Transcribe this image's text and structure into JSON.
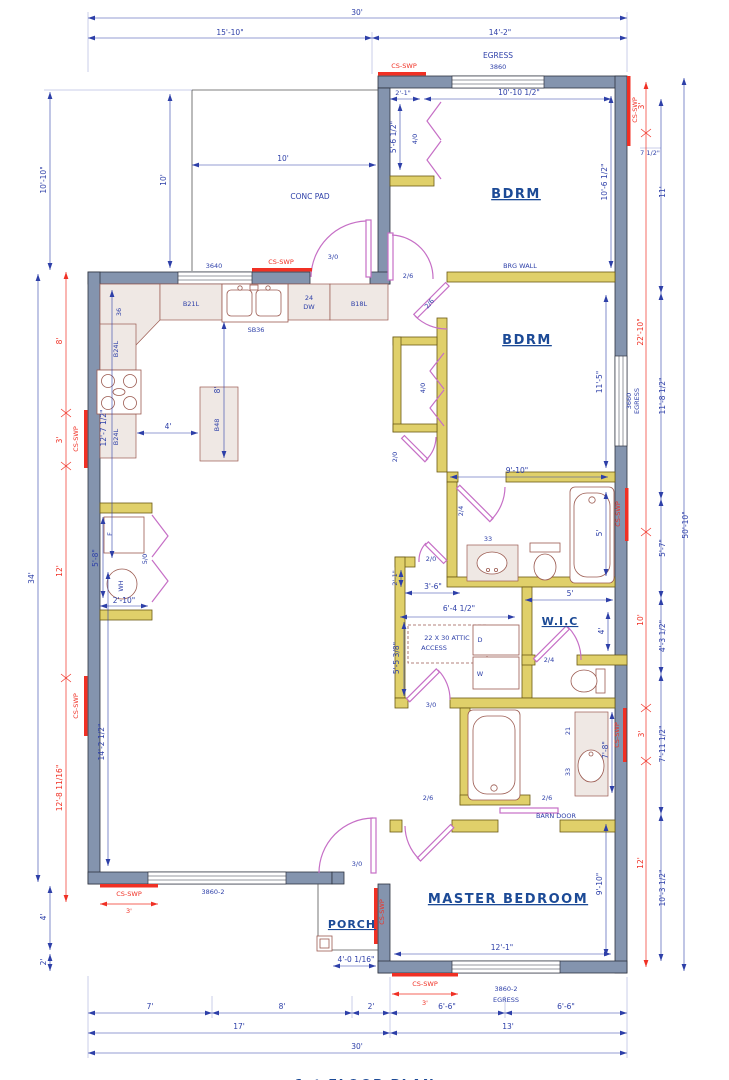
{
  "colors": {
    "wall": "#8494ae",
    "interior_wall": "#e0d06a",
    "door": "#c66fc6",
    "dim": "#2d3fa8",
    "shear": "#f03024",
    "fixture": "#9b5a50",
    "cabinet": "#efe8e4",
    "label": "#1c4a96"
  },
  "title": {
    "text": "1st FLOOR PLAN"
  },
  "shear": {
    "label": "CS-SWP",
    "len3": "3'"
  },
  "dims": {
    "top": {
      "overall": "30'",
      "left": "15'-10\"",
      "right": "14'-2\""
    },
    "bottom": {
      "s7": "7'",
      "s8": "8'",
      "s2": "2'",
      "s6a": "6'-6\"",
      "s6b": "6'-6\"",
      "s17": "17'",
      "s13": "13'",
      "s30": "30'"
    },
    "left": {
      "upper": "10'-10\"",
      "total": "34'",
      "red8": "8'",
      "red12": "12'",
      "red12_8": "12'-8 11/16\"",
      "low4": "4'",
      "low2": "2'",
      "inner12_7": "12'-7 1/2\"",
      "inner14_2": "14'-2 1/2\""
    },
    "right": {
      "red3a": "3'",
      "blue7h": "7 1/2\"",
      "blue11": "11'",
      "red22": "22'-10\"",
      "blue11_8": "11'-8 1/2\"",
      "blue5_7": "5'-7\"",
      "red10": "10'",
      "blue4_3": "4'-3 1/2\"",
      "blue7_11": "7'-11 1/2\"",
      "red12": "12'",
      "blue10_3": "10'-3 1/2\"",
      "total": "50'-10\""
    }
  },
  "areas": {
    "top_window": {
      "egress": "EGRESS",
      "size": "3860"
    },
    "bdrm1": {
      "name": "BDRM",
      "w": "10'-10 1/2\"",
      "h": "10'-6 1/2\"",
      "closet_w": "2'-1\"",
      "closet_h": "5'-6 1/2\"",
      "closet_door": "4/0",
      "brg": "BRG WALL",
      "door": "2/6",
      "door2": "2/6"
    },
    "conc": {
      "name": "CONC PAD",
      "w": "10'",
      "h": "10'",
      "window": "3640",
      "door": "3/0"
    },
    "kitchen": {
      "corner": "36",
      "b21l": "B21L",
      "sink": "SB36",
      "dw_top": "24",
      "dw_bot": "DW",
      "b18l": "B18L",
      "b24la": "B24L",
      "b24lb": "B24L",
      "island": "B48",
      "d4": "4'",
      "d8": "8'"
    },
    "utility": {
      "f": "F",
      "wh": "WH",
      "h": "5'-8\"",
      "w": "2'-10\"",
      "door": "5/0"
    },
    "living": {
      "window": "3860-2"
    },
    "bdrm2": {
      "name": "BDRM",
      "h": "11'-5\"",
      "w": "9'-10\"",
      "closet_door": "4/0",
      "nook_door": "2/0",
      "window": "3660",
      "egress": "EGRESS"
    },
    "bath1": {
      "vanity": "33",
      "tub": "5'",
      "door": "2/4"
    },
    "wic": {
      "name": "W.I.C",
      "w": "5'",
      "h": "4'",
      "door": "2/4"
    },
    "hall": {
      "nook_door": "2/0",
      "nook_w": "2'-1\"",
      "nook": "3'-6\"",
      "w": "6'-4 1/2\"",
      "attic1": "22 X 30 ATTIC",
      "attic2": "ACCESS",
      "dryer": "D",
      "washer": "W",
      "h": "5'-5 3/8\"",
      "door": "3/0"
    },
    "mbath": {
      "v21": "21",
      "v33": "33",
      "h": "7'-8\"",
      "door": "2/6",
      "barn_size": "2/6",
      "barn": "BARN DOOR"
    },
    "master": {
      "name": "MASTER BEDROOM",
      "w": "12'-1\"",
      "h": "9'-10\"",
      "window": "3860-2",
      "egress": "EGRESS"
    },
    "porch": {
      "name": "PORCH",
      "w": "4'-0 1/16\"",
      "door": "3/0"
    }
  }
}
